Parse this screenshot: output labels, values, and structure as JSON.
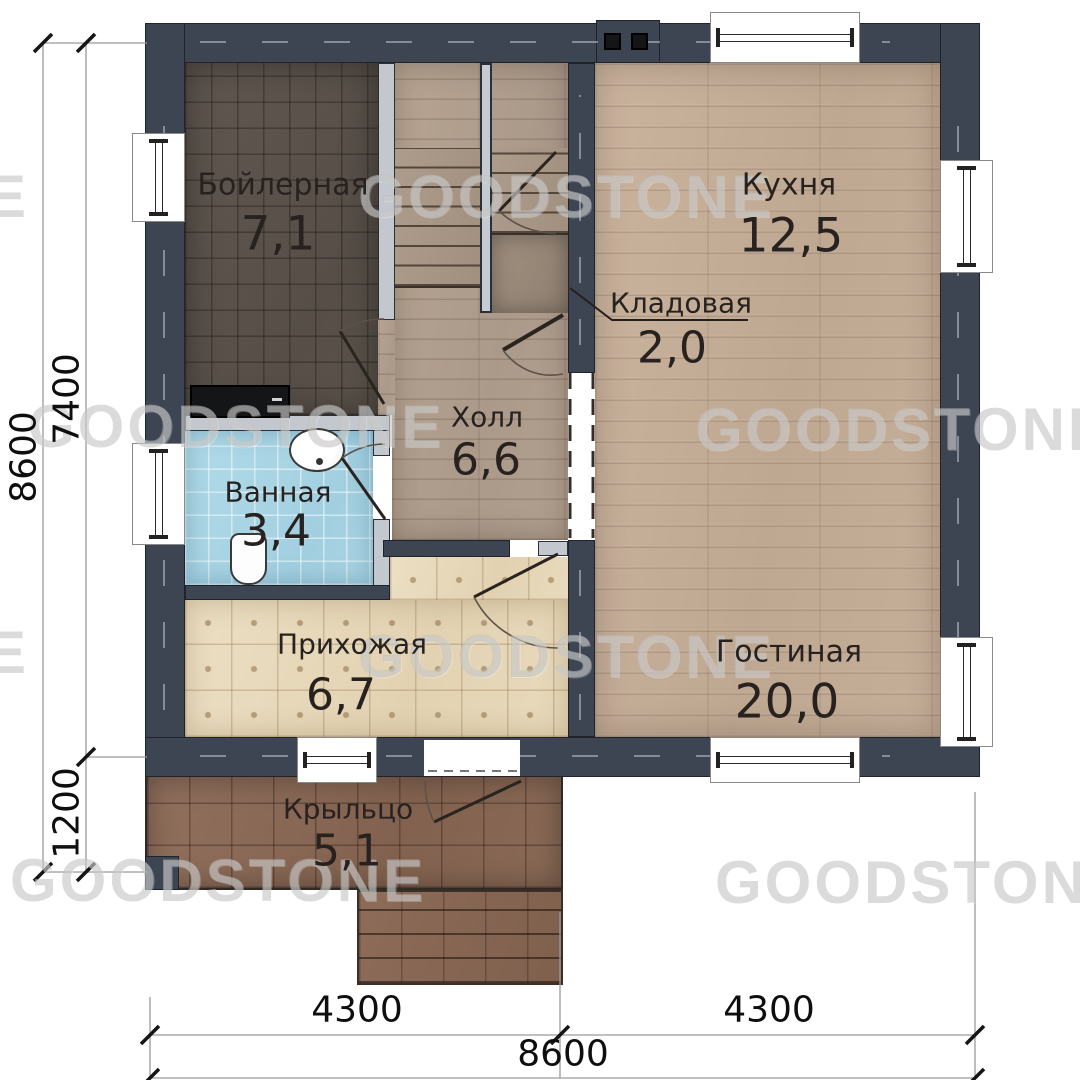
{
  "watermark": {
    "text": "GOODSTONE",
    "partial_letter": "E"
  },
  "rooms": [
    {
      "id": "boiler",
      "name": "Бойлерная",
      "area": "7,1"
    },
    {
      "id": "kitchen",
      "name": "Кухня",
      "area": "12,5"
    },
    {
      "id": "storage",
      "name": "Кладовая",
      "area": "2,0"
    },
    {
      "id": "hall",
      "name": "Холл",
      "area": "6,6"
    },
    {
      "id": "bathroom",
      "name": "Ванная",
      "area": "3,4"
    },
    {
      "id": "entry",
      "name": "Прихожая",
      "area": "6,7"
    },
    {
      "id": "living",
      "name": "Гостиная",
      "area": "20,0"
    },
    {
      "id": "porch",
      "name": "Крыльцо",
      "area": "5,1"
    }
  ],
  "dims": {
    "left_total": "8600",
    "left_upper": "7400",
    "left_lower": "1200",
    "bottom_a": "4300",
    "bottom_b": "4300",
    "bottom_total": "8600"
  },
  "colors": {
    "wall": "#3d4553",
    "partition_silver": "#c3c8ce",
    "floor_wood": "#c1ab95",
    "floor_hall": "#b0a08f",
    "floor_boiler": "#5a524b",
    "floor_bath": "#a7d2e2",
    "floor_entry": "#e9dcbe",
    "floor_porch": "#8a6857"
  }
}
